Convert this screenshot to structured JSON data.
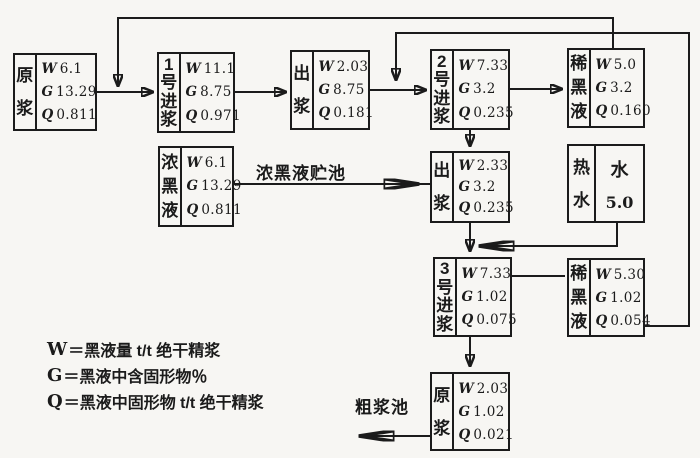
{
  "colors": {
    "ink": "#1b1b1b",
    "paper": "#f7f6f3"
  },
  "boxes": [
    {
      "id": "raw-pulp-1",
      "label": "原浆",
      "rows": [
        {
          "k": "W",
          "v": "6.1"
        },
        {
          "k": "G",
          "v": "13.29"
        },
        {
          "k": "Q",
          "v": "0.811"
        }
      ]
    },
    {
      "id": "stage1-feed",
      "label": "1号进浆",
      "rows": [
        {
          "k": "W",
          "v": "11.1"
        },
        {
          "k": "G",
          "v": "8.75"
        },
        {
          "k": "Q",
          "v": "0.971"
        }
      ]
    },
    {
      "id": "stage1-outlet",
      "label": "出浆",
      "rows": [
        {
          "k": "W",
          "v": "2.03"
        },
        {
          "k": "G",
          "v": "8.75"
        },
        {
          "k": "Q",
          "v": "0.181"
        }
      ]
    },
    {
      "id": "stage2-feed",
      "label": "2号进浆",
      "rows": [
        {
          "k": "W",
          "v": "7.33"
        },
        {
          "k": "G",
          "v": "3.2"
        },
        {
          "k": "Q",
          "v": "0.235"
        }
      ]
    },
    {
      "id": "dilute-liquor-1",
      "label": "稀黑液",
      "rows": [
        {
          "k": "W",
          "v": "5.0"
        },
        {
          "k": "G",
          "v": "3.2"
        },
        {
          "k": "Q",
          "v": "0.160"
        }
      ]
    },
    {
      "id": "strong-liquor",
      "label": "浓黑液",
      "rows": [
        {
          "k": "W",
          "v": "6.1"
        },
        {
          "k": "G",
          "v": "13.29"
        },
        {
          "k": "Q",
          "v": "0.811"
        }
      ]
    },
    {
      "id": "stage2-outlet",
      "label": "出浆",
      "rows": [
        {
          "k": "W",
          "v": "2.33"
        },
        {
          "k": "G",
          "v": "3.2"
        },
        {
          "k": "Q",
          "v": "0.235"
        }
      ]
    },
    {
      "id": "hot-water",
      "label": "热水",
      "right_top": "水",
      "right_bottom": "5.0"
    },
    {
      "id": "stage3-feed",
      "label": "3号进浆",
      "rows": [
        {
          "k": "W",
          "v": "7.33"
        },
        {
          "k": "G",
          "v": "1.02"
        },
        {
          "k": "Q",
          "v": "0.075"
        }
      ]
    },
    {
      "id": "dilute-liquor-2",
      "label": "稀黑液",
      "rows": [
        {
          "k": "W",
          "v": "5.30"
        },
        {
          "k": "G",
          "v": "1.02"
        },
        {
          "k": "Q",
          "v": "0.054"
        }
      ]
    },
    {
      "id": "raw-pulp-out",
      "label": "原浆",
      "rows": [
        {
          "k": "W",
          "v": "2.03"
        },
        {
          "k": "G",
          "v": "1.02"
        },
        {
          "k": "Q",
          "v": "0.021"
        }
      ]
    }
  ],
  "labels": {
    "storage_pond": "浓黑液贮池",
    "coarse_pulp_pond": "粗浆池"
  },
  "legend": {
    "lines": [
      {
        "symbol": "W",
        "text": "＝黑液量 t/t 绝干精浆"
      },
      {
        "symbol": "G",
        "text": "＝黑液中含固形物％"
      },
      {
        "symbol": "Q",
        "text": "＝黑液中固形物 t/t 绝干精浆"
      }
    ]
  }
}
